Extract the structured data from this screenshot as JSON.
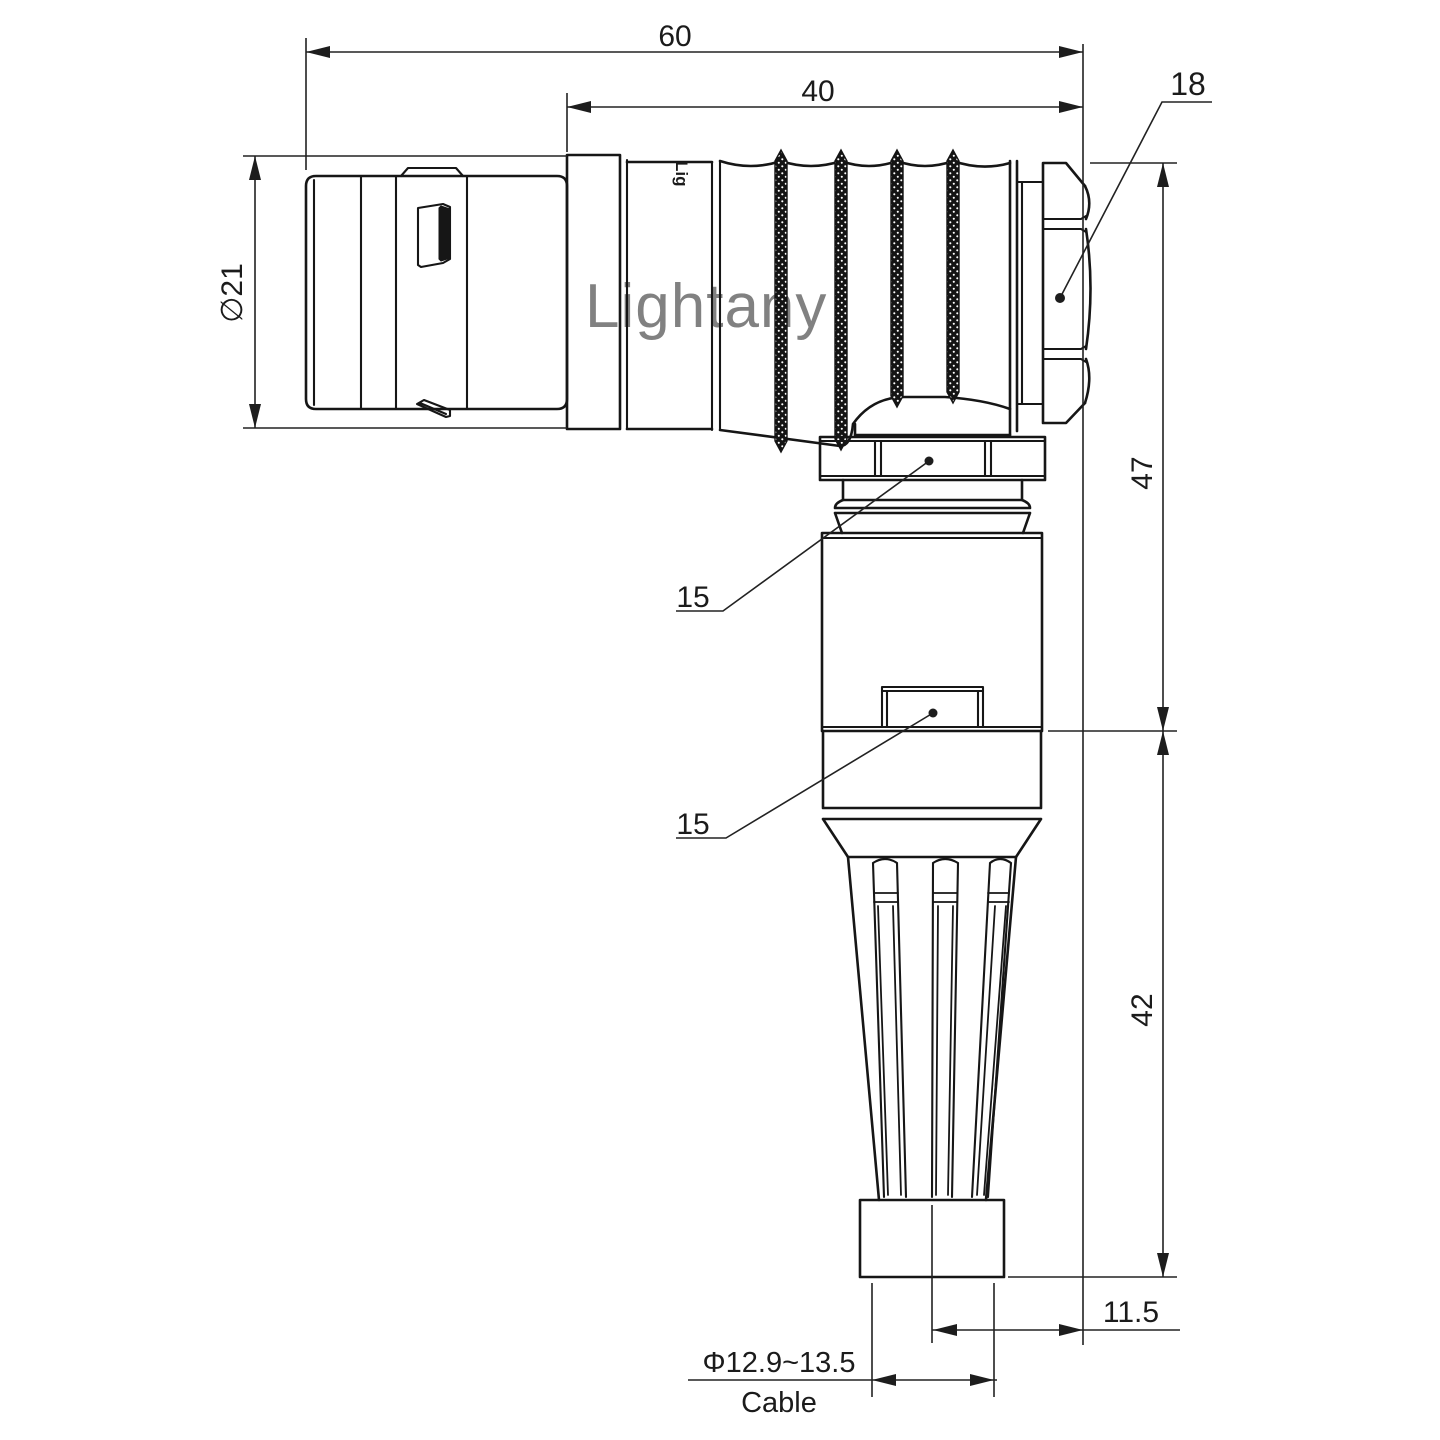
{
  "drawing": {
    "watermark": "Lightany",
    "engraving": "Lig",
    "colors": {
      "line": "#161616",
      "dimension": "#222222",
      "watermark": "#f5c0c0"
    },
    "labels": {
      "overall_length": "60",
      "front_length": "40",
      "backnut_ref": "18",
      "coupling_diameter": "∅21",
      "upper_height": "47",
      "lower_height": "42",
      "axis_to_face": "11.5",
      "cable_diameter": "Φ12.9~13.5",
      "cable_word": "Cable",
      "gland_ref": "15",
      "clamp_ref": "15"
    }
  }
}
